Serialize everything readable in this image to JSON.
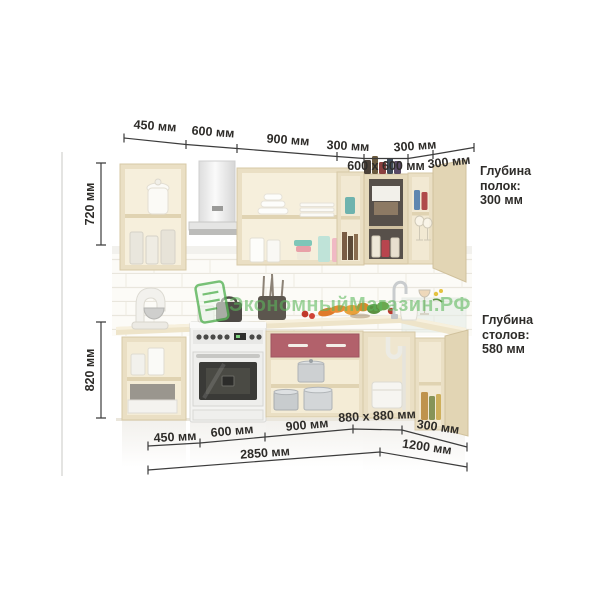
{
  "watermark": {
    "text": "ЭкономныйМагазин.РФ",
    "color": "#5cb85c"
  },
  "dimensions": {
    "top": [
      "450 мм",
      "600 мм",
      "900 мм",
      "300 мм",
      "300 мм",
      "600 x 600 мм",
      "300 мм"
    ],
    "left": [
      "720 мм",
      "820 мм"
    ],
    "bottom": [
      "450 мм",
      "600 мм",
      "900 мм",
      "880 x 880 мм",
      "300 мм"
    ],
    "totals": [
      "2850 мм",
      "1200 мм"
    ]
  },
  "depth_notes": {
    "shelves": [
      "Глубина",
      "полок:",
      "300 мм"
    ],
    "tables": [
      "Глубина",
      "столов:",
      "580 мм"
    ]
  },
  "scene": {
    "objects": [
      "wall-cabinet-450",
      "range-hood-600",
      "wall-cabinet-900",
      "wall-cabinet-300",
      "corner-wall-cabinet-600x600",
      "wall-cabinet-300-right",
      "base-cabinet-450",
      "stove-600",
      "base-cabinet-900-red-drawer",
      "corner-base-cabinet-880x880",
      "base-cabinet-300-right",
      "stand-mixer",
      "cookware",
      "vegetables",
      "faucet",
      "pitcher",
      "wine-glass"
    ]
  },
  "colors": {
    "cabinet": "#eadfc4",
    "accent_drawer": "#b2616b",
    "dimension_text": "#2e2c29",
    "watermark_green": "#5cb85c"
  }
}
